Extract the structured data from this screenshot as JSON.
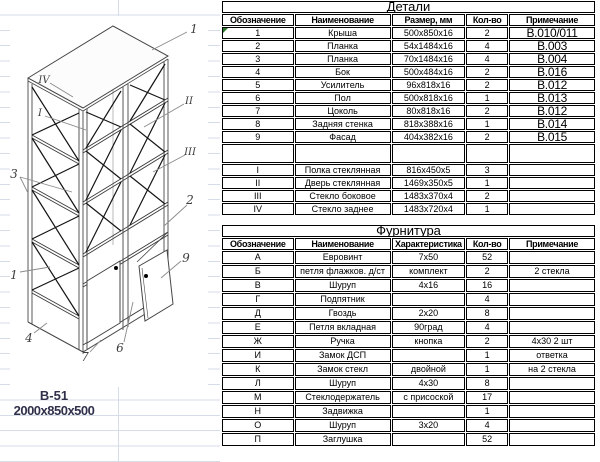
{
  "drawing": {
    "model": "В-51",
    "dimensions": "2000x850x500",
    "labels": [
      "1",
      "IV",
      "I",
      "3",
      "1",
      "4",
      "7",
      "6",
      "9",
      "II",
      "III",
      "2"
    ]
  },
  "tables": {
    "details": {
      "title": "Детали",
      "headers": [
        "Обозначение",
        "Наименование",
        "Размер, мм",
        "Кол-во",
        "Примечание"
      ],
      "rows": [
        [
          "1",
          "Крыша",
          "500x850x16",
          "2",
          "В.010/011"
        ],
        [
          "2",
          "Планка",
          "54x1484x16",
          "4",
          "В.003"
        ],
        [
          "3",
          "Планка",
          "70x1484x16",
          "4",
          "В.004"
        ],
        [
          "4",
          "Бок",
          "500x484x16",
          "2",
          "В.016"
        ],
        [
          "5",
          "Усилитель",
          "96x818x16",
          "2",
          "В.012"
        ],
        [
          "6",
          "Пол",
          "500x818x16",
          "1",
          "В.013"
        ],
        [
          "7",
          "Цоколь",
          "80x818x16",
          "2",
          "В.012"
        ],
        [
          "8",
          "Задняя стенка",
          "818x388x16",
          "1",
          "В.014"
        ],
        [
          "9",
          "Фасад",
          "404x382x16",
          "2",
          "В.015"
        ],
        [
          "",
          "",
          "",
          "",
          ""
        ],
        [
          "I",
          "Полка стеклянная",
          "816x450x5",
          "3",
          ""
        ],
        [
          "II",
          "Дверь стеклянная",
          "1469x350x5",
          "1",
          ""
        ],
        [
          "III",
          "Стекло боковое",
          "1483x370x4",
          "2",
          ""
        ],
        [
          "IV",
          "Стекло заднее",
          "1483x720x4",
          "1",
          ""
        ]
      ]
    },
    "hardware": {
      "title": "Фурнитура",
      "headers": [
        "Обозначение",
        "Наименование",
        "Характеристика",
        "Кол-во",
        "Примечание"
      ],
      "rows": [
        [
          "А",
          "Евровинт",
          "7x50",
          "52",
          ""
        ],
        [
          "Б",
          "петля флажков. д/ст",
          "комплект",
          "2",
          "2 стекла"
        ],
        [
          "В",
          "Шуруп",
          "4x16",
          "16",
          ""
        ],
        [
          "Г",
          "Подпятник",
          "",
          "4",
          ""
        ],
        [
          "Д",
          "Гвоздь",
          "2x20",
          "8",
          ""
        ],
        [
          "Е",
          "Петля вкладная",
          "90град",
          "4",
          ""
        ],
        [
          "Ж",
          "Ручка",
          "кнопка",
          "2",
          "4x30  2 шт"
        ],
        [
          "И",
          "Замок ДСП",
          "",
          "1",
          "ответка"
        ],
        [
          "К",
          "Замок стекл",
          "двойной",
          "1",
          "на 2 стекла"
        ],
        [
          "Л",
          "Шуруп",
          "4x30",
          "8",
          ""
        ],
        [
          "М",
          "Стеклодержатель",
          "с присоской",
          "17",
          ""
        ],
        [
          "Н",
          "Задвижка",
          "",
          "1",
          ""
        ],
        [
          "О",
          "Шуруп",
          "3x20",
          "4",
          ""
        ],
        [
          "П",
          "Заглушка",
          "",
          "52",
          ""
        ]
      ]
    }
  }
}
